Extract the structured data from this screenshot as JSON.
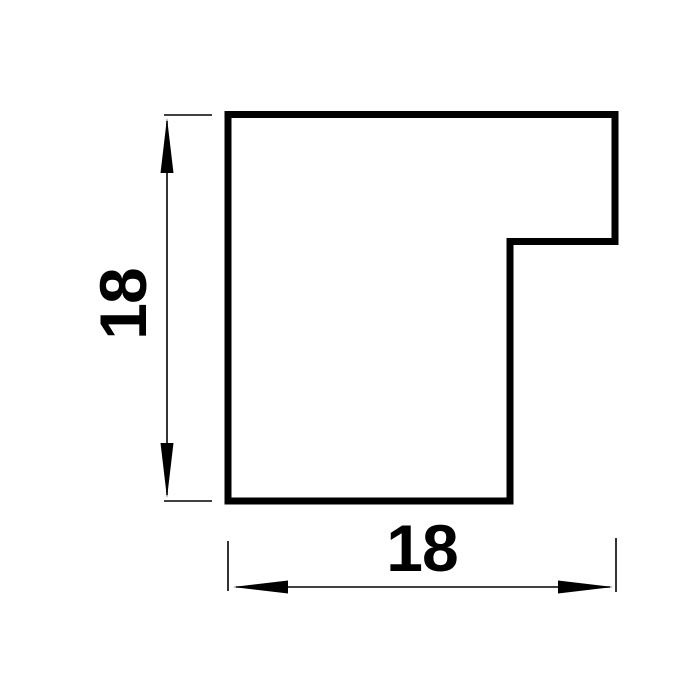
{
  "drawing": {
    "dimensions": {
      "height": {
        "value": "18"
      },
      "width": {
        "value": "18"
      }
    },
    "colors": {
      "line": "#000000",
      "background": "#ffffff"
    }
  }
}
